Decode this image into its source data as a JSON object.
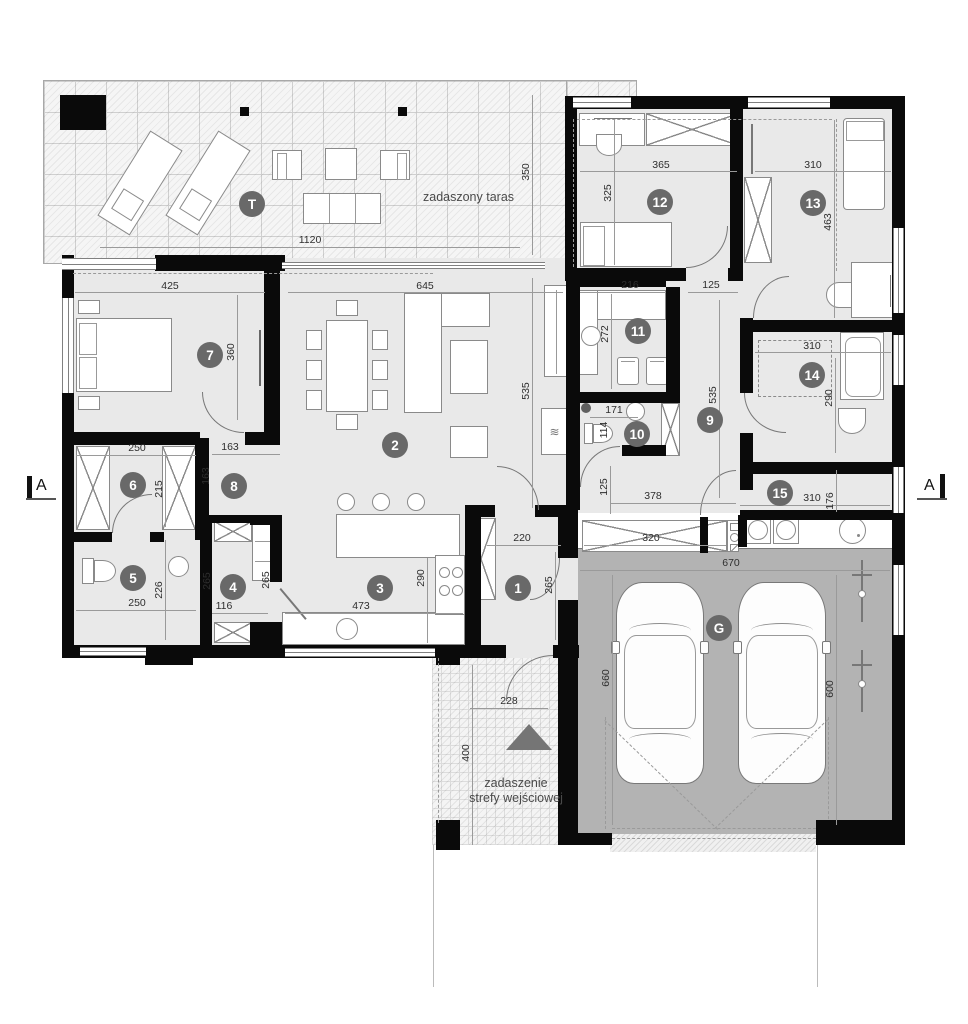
{
  "rooms": [
    "T",
    "1",
    "2",
    "3",
    "4",
    "5",
    "6",
    "7",
    "8",
    "9",
    "10",
    "11",
    "12",
    "13",
    "14",
    "15",
    "G"
  ],
  "dims": [
    "1120",
    "350",
    "425",
    "360",
    "645",
    "535",
    "365",
    "325",
    "310",
    "463",
    "216",
    "125",
    "272",
    "171",
    "114",
    "535",
    "310",
    "290",
    "250",
    "215",
    "163",
    "163",
    "250",
    "226",
    "265",
    "116",
    "265",
    "473",
    "290",
    "220",
    "265",
    "125",
    "378",
    "310",
    "176",
    "320",
    "670",
    "660",
    "600",
    "228",
    "400"
  ],
  "texts": {
    "terrace_label": "zadaszony taras",
    "entrance_label_line1": "zadaszenie",
    "entrance_label_line2": "strefy wejściowej",
    "section_marker_left": "A",
    "section_marker_right": "A"
  },
  "colors": {
    "wall": "#0a0a0a",
    "floor": "#e9e9e9",
    "garage_floor": "#b3b3b3",
    "room_label_bg": "#696969",
    "dim_text": "#2e2e2e"
  }
}
